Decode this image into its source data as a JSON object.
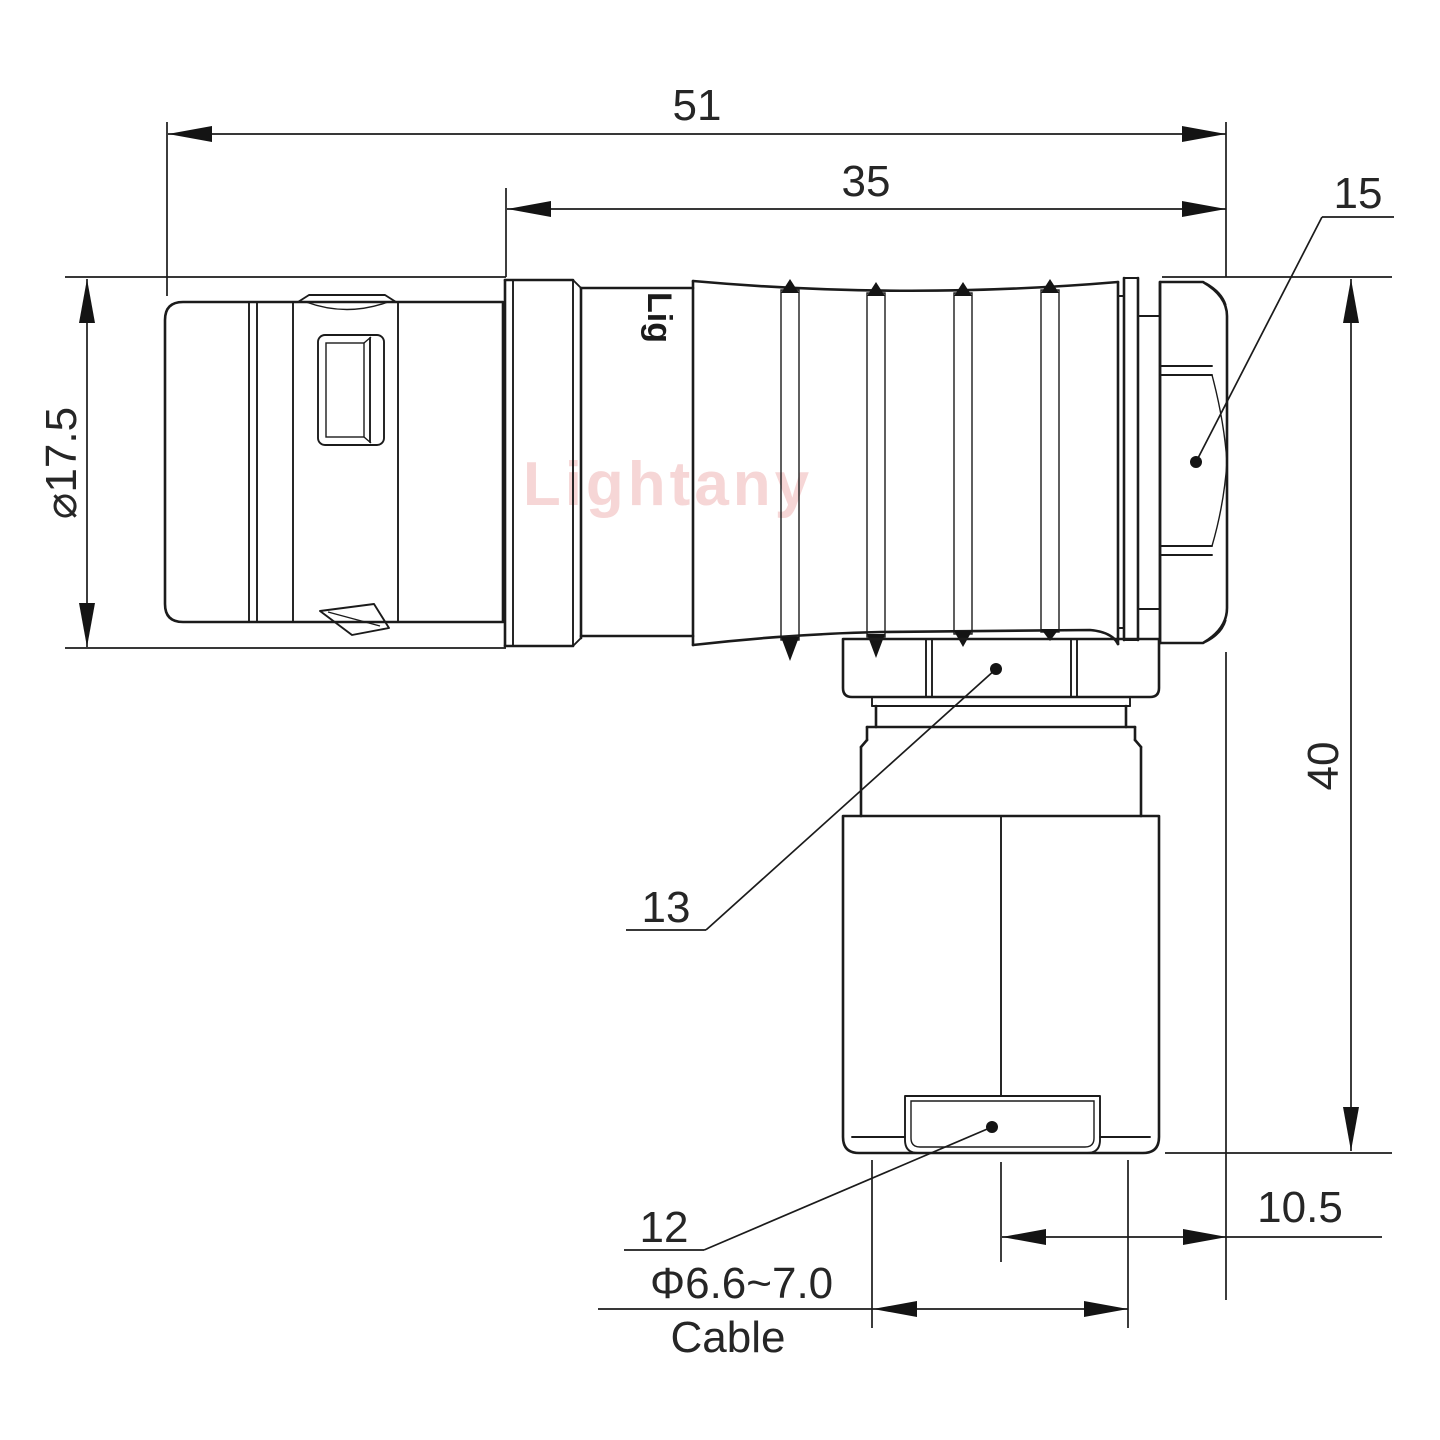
{
  "drawing": {
    "title": "Right-angle plug connector outline drawing",
    "watermark": "Lightany",
    "body_print": "Lig",
    "dimensions": {
      "overall_length": "51",
      "front_length": "35",
      "shell_diameter": "⌀17.5",
      "height": "40",
      "exit_offset": "10.5",
      "cable_range": "Φ6.6~7.0",
      "cable_label": "Cable"
    },
    "part_labels": {
      "backnut": "15",
      "gland_nut": "13",
      "cable_bushing": "12"
    },
    "colors": {
      "line": "#1b1b1b",
      "watermark": "#eeafaf",
      "background": "#ffffff"
    }
  }
}
